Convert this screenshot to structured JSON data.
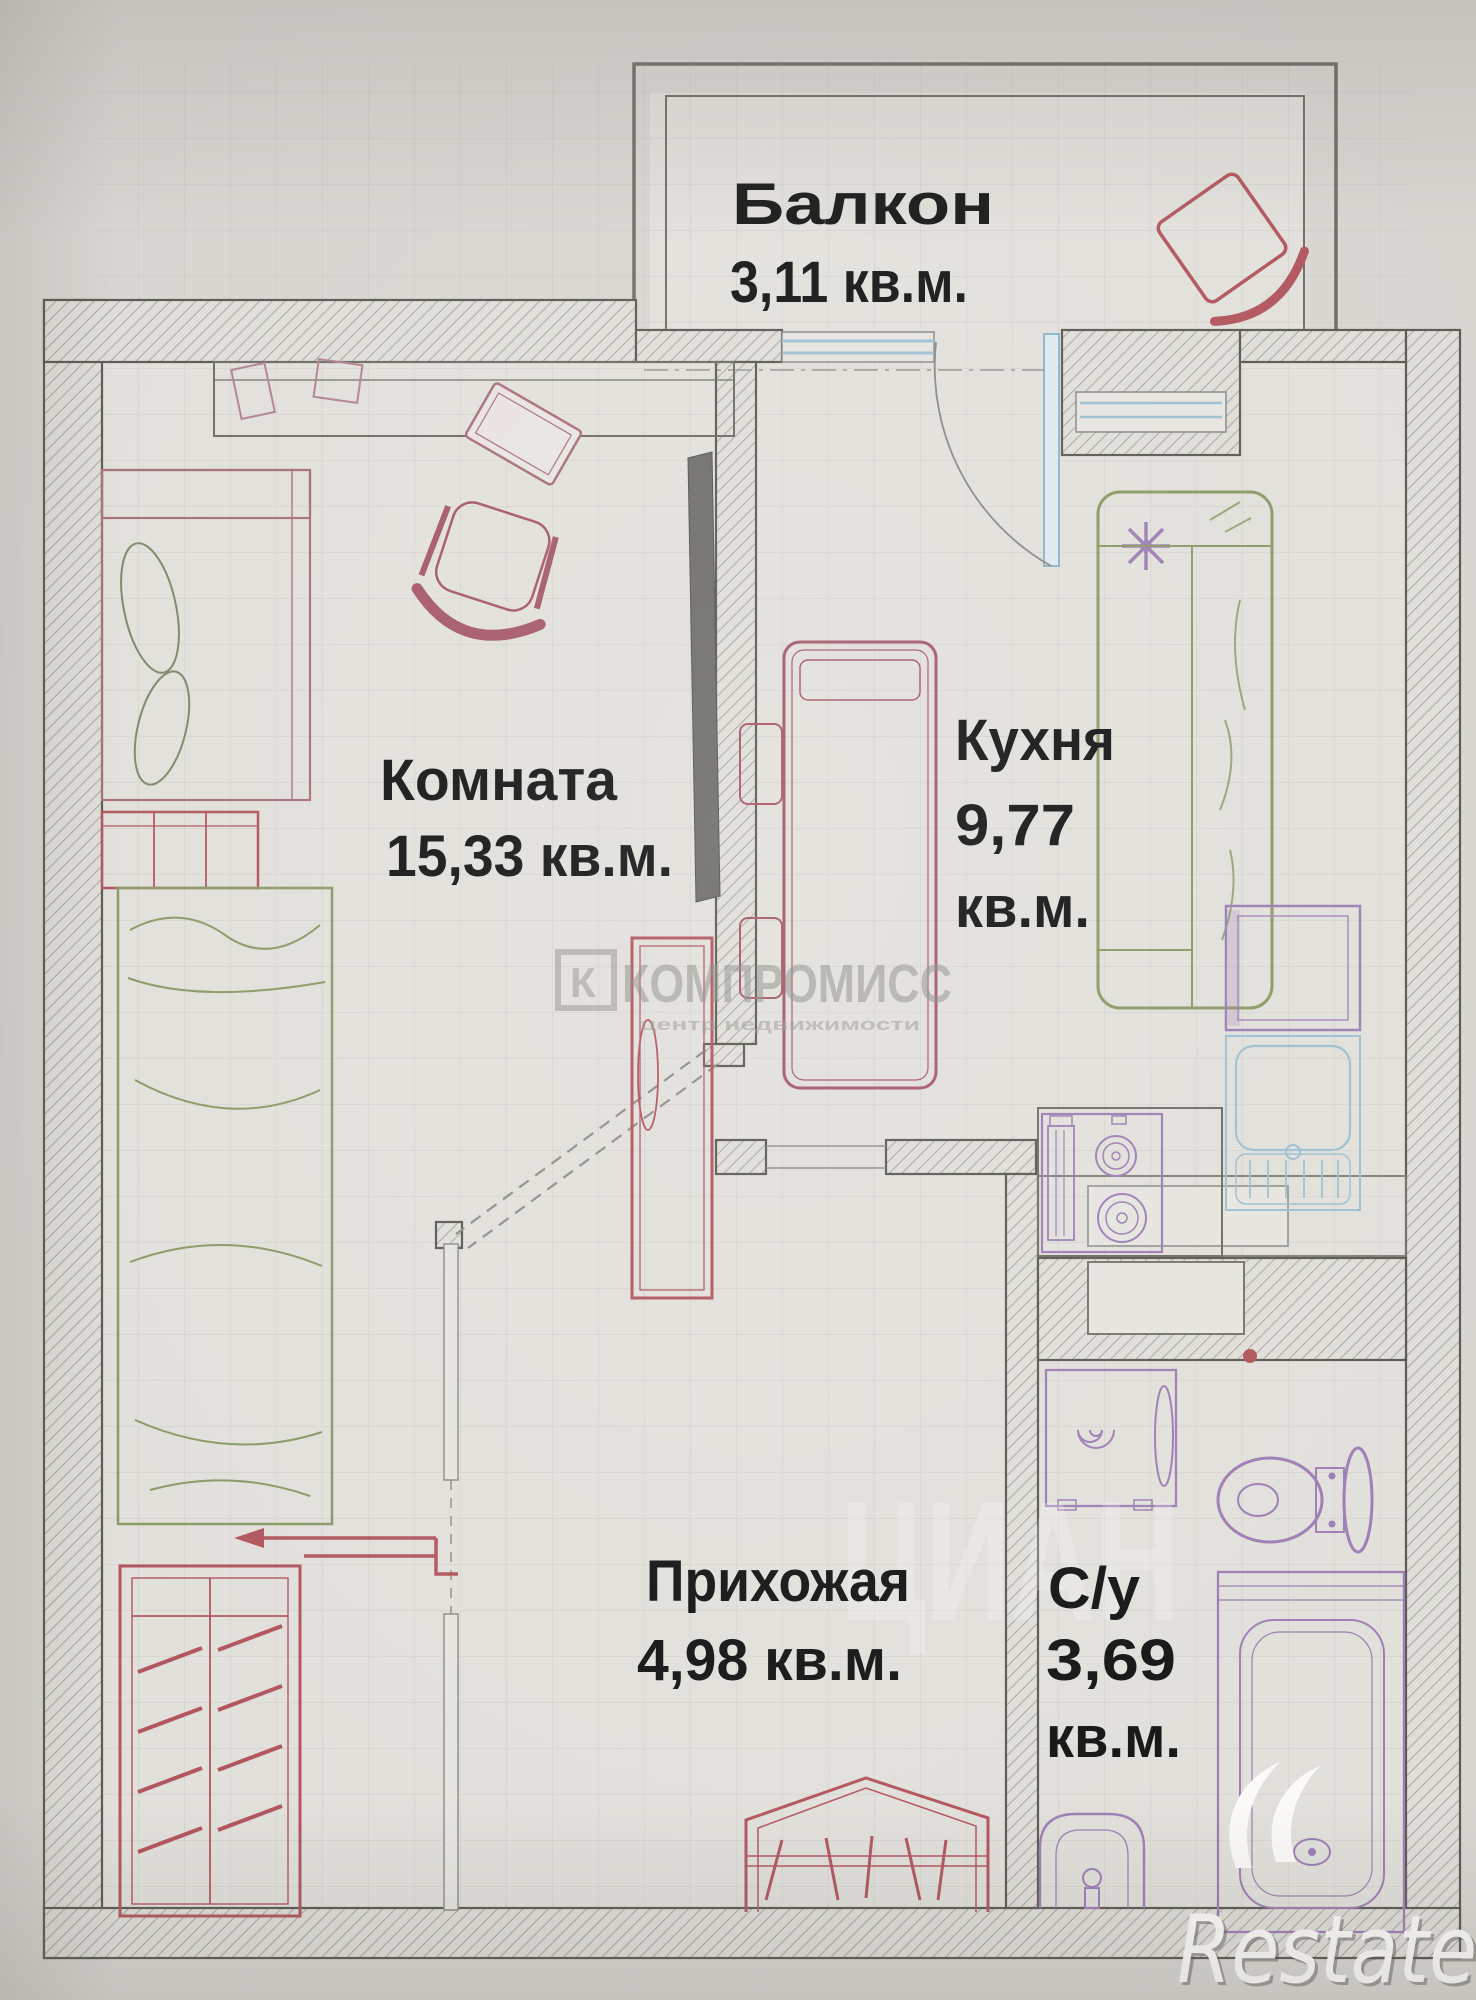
{
  "rooms": {
    "balcony": {
      "name": "Балкон",
      "area": "3,11 кв.м."
    },
    "room": {
      "name": "Комната",
      "area": "15,33 кв.м."
    },
    "kitchen": {
      "name": "Кухня",
      "area_value": "9,77",
      "area_unit": "кв.м."
    },
    "hallway": {
      "name": "Прихожая",
      "area": "4,98 кв.м."
    },
    "bathroom": {
      "name": "С/у",
      "area_value": "3,69",
      "area_unit": "кв.м."
    }
  },
  "watermarks": {
    "agency_logo_letter": "К",
    "agency_name": "КОМПРОМИСС",
    "agency_tagline": "центр недвижимости",
    "portal_name": "ЦИАН",
    "footer_logo": "Restate"
  },
  "colors": {
    "walls": "#5b5a53",
    "furniture_red": "#b2565f",
    "furniture_green": "#8a9a66",
    "fixtures_purple": "#9d7fb5",
    "fixtures_blue": "#9ec0d2",
    "label_text": "#161616",
    "watermark_gray": "#96958f",
    "paper": "#e2e0db"
  }
}
